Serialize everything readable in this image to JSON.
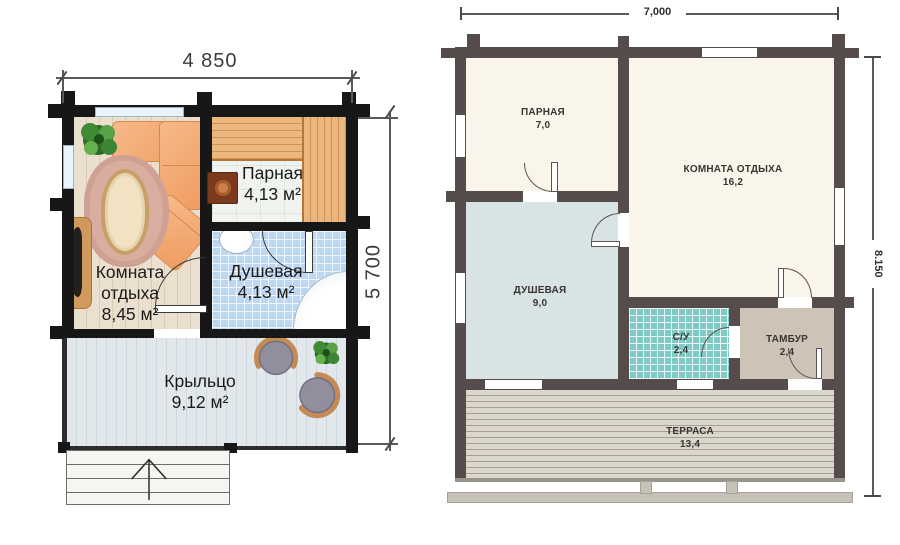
{
  "left_plan": {
    "dim_width": "4 850",
    "dim_height": "5 700",
    "rooms": {
      "parnaya": {
        "name": "Парная",
        "area": "4,13 м²"
      },
      "otdyha": {
        "name": "Комната отдыха",
        "area": "8,45 м²"
      },
      "dushevaya": {
        "name": "Душевая",
        "area": "4,13 м²"
      },
      "kryltso": {
        "name": "Крыльцо",
        "area": "9,12 м²"
      }
    }
  },
  "right_plan": {
    "dim_width": "7,000",
    "dim_height": "8.150",
    "rooms": {
      "parnaya": {
        "name": "ПАРНАЯ",
        "area": "7,0"
      },
      "otdyha": {
        "name": "КОМНАТА ОТДЫХА",
        "area": "16,2"
      },
      "dushevaya": {
        "name": "ДУШЕВАЯ",
        "area": "9,0"
      },
      "su": {
        "name": "С/У",
        "area": "2,4"
      },
      "tambur": {
        "name": "ТАМБУР",
        "area": "2,4"
      },
      "terrasa": {
        "name": "ТЕРРАСА",
        "area": "13,4"
      }
    }
  },
  "colors": {
    "wall_left_plan": "#171717",
    "wall_right_plan": "#564c4c",
    "floor_cream": "#faf5ea",
    "floor_wood": "#e9decd",
    "floor_shower_left": "#bcd8f3",
    "floor_shower_right": "#d8e3e4",
    "floor_tile_su": "#7ecbc6",
    "floor_tambur": "#cdc4b7",
    "floor_porch": "#dfe6ea",
    "terrace_deck": "#d9d5cb",
    "sofa_orange": "#f3a873",
    "dim_text": "#3c3c3c"
  }
}
